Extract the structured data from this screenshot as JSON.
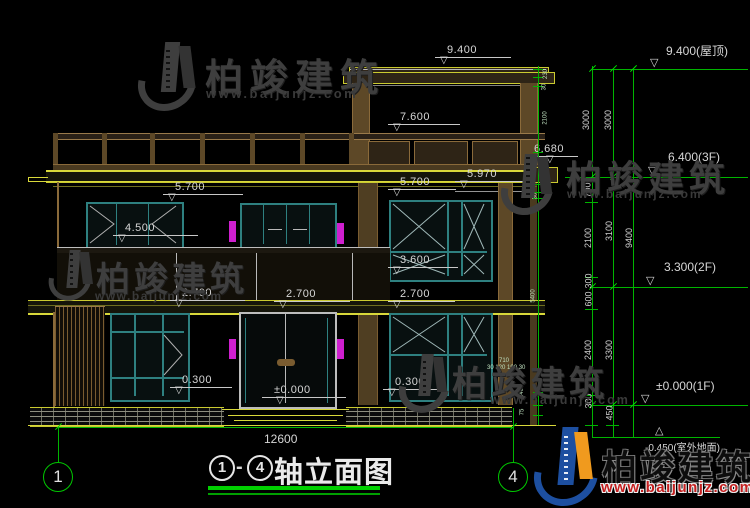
{
  "brand": {
    "name": "柏竣建筑",
    "url": "www.baijunjz.com"
  },
  "title_block": {
    "axis_left": "1",
    "separator": "-",
    "axis_right": "4",
    "name": "轴立面图"
  },
  "axes": {
    "left": "1",
    "right": "4"
  },
  "overall_dim": "12600",
  "building_markers": [
    {
      "label": "9.400"
    },
    {
      "label": "7.600"
    },
    {
      "label": "6.680"
    },
    {
      "label": "5.700"
    },
    {
      "label": "5.970"
    },
    {
      "label": "5.700"
    },
    {
      "label": "4.500"
    },
    {
      "label": "3.600"
    },
    {
      "label": "2.700"
    },
    {
      "label": "2.700"
    },
    {
      "label": "2.700"
    },
    {
      "label": "0.300"
    },
    {
      "label": "0.300"
    },
    {
      "label": "±0.000"
    }
  ],
  "floor_markers": [
    {
      "label": "9.400(屋顶)"
    },
    {
      "label": "6.400(3F)"
    },
    {
      "label": "3.300(2F)"
    },
    {
      "label": "±0.000(1F)"
    },
    {
      "label": "-0.450(室外地面)"
    }
  ],
  "dims": {
    "right_chain": [
      "3000",
      "3000",
      "700",
      "2100",
      "300",
      "600",
      "2400",
      "300",
      "450",
      "3100",
      "3300",
      "9400"
    ],
    "wall_chain": [
      "230",
      "30",
      "2100",
      "50",
      "30",
      "5400",
      "240",
      "75"
    ],
    "micro": [
      "710",
      "30 120 190 30"
    ]
  },
  "colors": {
    "dim_green": "#00b400",
    "cad_yellow": "#d8d83a",
    "frame_teal": "#2e8080",
    "lamp_magenta": "#cf1fcf",
    "logo_blue": "#1d4fa0",
    "logo_orange": "#f09a1e",
    "url_red": "#c51f1f"
  }
}
